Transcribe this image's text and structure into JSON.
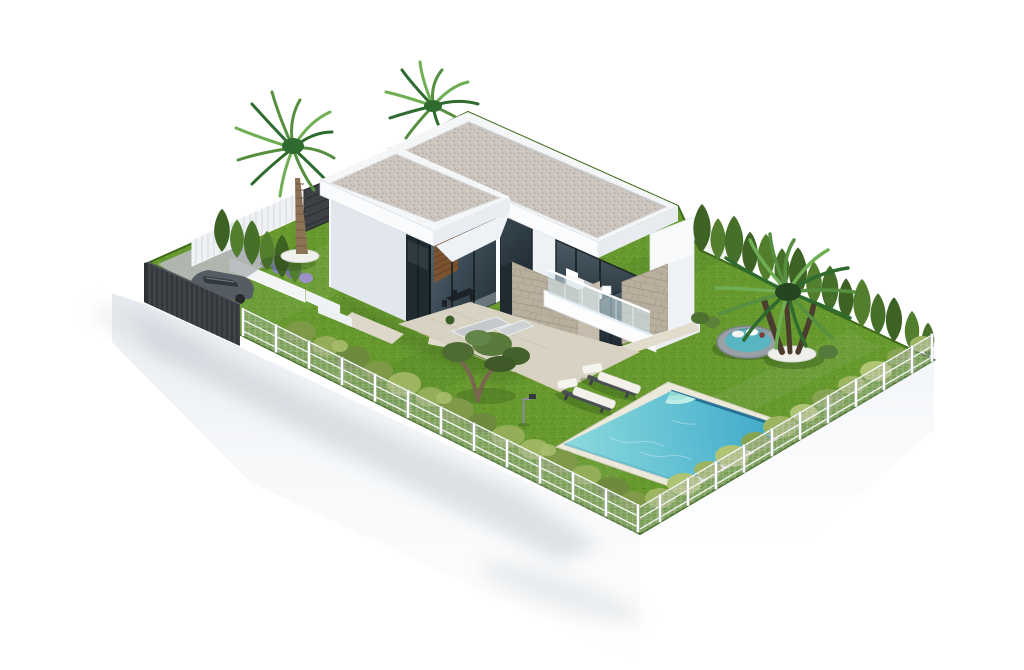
{
  "scene": {
    "description": "Aerial isometric 3D architectural rendering of a modern two-storey white villa with flat gravel roofs, glass facades, a stone-clad wall, landscaped lawn, swimming pool with corner steps, two sun loungers, a round daybed, palm trees, cypress hedges, a dark carport wall with parked car and a white mesh perimeter fence, presented on a floating white base over a white background.",
    "background": "#ffffff",
    "objects": [
      {
        "id": "villa",
        "label": "Modern two-storey white villa"
      },
      {
        "id": "main-roof-slab",
        "label": "Flat gravel roof - main volume"
      },
      {
        "id": "front-roof-slab",
        "label": "Flat gravel roof - front volume"
      },
      {
        "id": "glass-corner-living-room",
        "label": "Double-height corner glazing with dining set"
      },
      {
        "id": "bedroom-balcony",
        "label": "Upstairs bedroom with glass-railed balcony and white furniture"
      },
      {
        "id": "stone-clad-wall",
        "label": "Natural stone clad pillar"
      },
      {
        "id": "interior-wood-wall",
        "label": "Interior wood slat wall"
      },
      {
        "id": "roof-palm-tree",
        "label": "Palm canopy behind roof"
      },
      {
        "id": "left-palm-tree",
        "label": "Tall fan palm in side garden"
      },
      {
        "id": "right-palm-tree",
        "label": "Multi-trunk palm on round planter"
      },
      {
        "id": "olive-tree",
        "label": "Gnarled olive tree"
      },
      {
        "id": "garden-lawn",
        "label": "Green lawn"
      },
      {
        "id": "swimming-pool",
        "label": "Rectangular turquoise pool with corner steps"
      },
      {
        "id": "sun-loungers",
        "label": "White sun loungers",
        "count": 2
      },
      {
        "id": "round-daybed",
        "label": "Round rattan daybed with teal cushions"
      },
      {
        "id": "outdoor-sofa-set",
        "label": "Grey terrace lounge set"
      },
      {
        "id": "garden-lamp",
        "label": "Small garden lamp post"
      },
      {
        "id": "terrace-paving",
        "label": "Beige terrace paving"
      },
      {
        "id": "carport-dark-wall",
        "label": "Dark slatted carport wall"
      },
      {
        "id": "parked-car",
        "label": "Dark parked car"
      },
      {
        "id": "lavender-planter",
        "label": "White planter wall with lavender"
      },
      {
        "id": "cypress-hedge-back-right",
        "label": "Cypress hedge along back-right boundary"
      },
      {
        "id": "cypress-row-back-left",
        "label": "Cypress row in side garden"
      },
      {
        "id": "white-slat-fence",
        "label": "White slat fence back-left"
      },
      {
        "id": "dark-gate",
        "label": "Dark entrance gate panel"
      },
      {
        "id": "perimeter-mesh-fence",
        "label": "White post and mesh perimeter fence"
      },
      {
        "id": "perimeter-hedge-bushes",
        "label": "Loose hedge bushes along fence"
      },
      {
        "id": "white-presentation-base",
        "label": "White floating presentation base with soft shadows"
      }
    ]
  },
  "colors": {
    "background": "#ffffff",
    "grass": "#67992f",
    "grass_dark": "#4c7a20",
    "grass_light": "#7fb13f",
    "pool_shallow": "#8ad9dd",
    "pool_deep": "#3aa6c8",
    "pool_edge": "#16658c",
    "pool_steps": "#bfeee8",
    "pool_coping": "#ece8da",
    "roof_gravel": "#cdc6be",
    "roof_gravel_dot": "#aaa196",
    "roof_white": "#f4f6f8",
    "wall_bright": "#fbfcfe",
    "wall_light": "#eef1f5",
    "wall_shade": "#e2e7ee",
    "glass_dark": "#1f2a31",
    "glass_mid": "#3c4c56",
    "glass_light": "#5d707b",
    "stone": "#b9af9f",
    "stone_line": "#978c7b",
    "wood": "#7c5331",
    "terrace": "#d8d2c2",
    "walkway": "#e2dccd",
    "fence_post": "#fdfdfe",
    "fence_mesh": "#aab1b6",
    "dark_wall": "#3f4246",
    "gate": "#3d4145",
    "car_body": "#565c63",
    "car_glass": "#33383d",
    "conifer_dark": "#3e6224",
    "conifer_mid": "#527e2e",
    "conifer_deep": "#46702a",
    "hedge_a": "#7e9a48",
    "hedge_b": "#93ad58",
    "hedge_c": "#6d8a3d",
    "hedge_d": "#9db560",
    "hedge_e": "#86a351",
    "hedge_f": "#b0c573",
    "palm_dark": "#2f6b2f",
    "palm_mid": "#568f3f",
    "palm_light": "#6fae52",
    "trunk": "#8d7355",
    "palm_trunk_dark": "#4a3d2e",
    "lavender": "#8d84bd",
    "daybed_rim": "#9aa1a6",
    "daybed_cushion": "#59b5c2",
    "lounger_cushion": "#f3f1ea",
    "lounger_frame": "#4a4f53",
    "shadow_soft": "#bcc3ca"
  }
}
